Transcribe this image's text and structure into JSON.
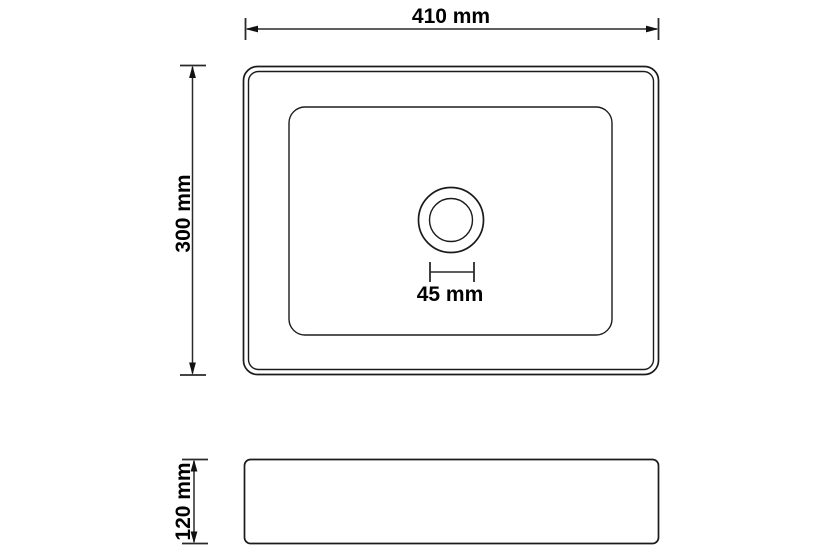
{
  "diagram": {
    "kind": "technical-dimension-drawing",
    "subject": "rectangular-wash-basin",
    "background_color": "#ffffff",
    "line_color": "#1b1b1b",
    "views": {
      "top_view": "plan view with basin cavity and drain hole",
      "side_view": "front elevation"
    }
  },
  "measurements": {
    "overall_width": {
      "label": "410 mm",
      "value": 410,
      "unit": "mm"
    },
    "overall_depth": {
      "label": "300 mm",
      "value": 300,
      "unit": "mm"
    },
    "drain_diameter": {
      "label": "45 mm",
      "value": 45,
      "unit": "mm"
    },
    "overall_height": {
      "label": "120 mm",
      "value": 120,
      "unit": "mm"
    }
  }
}
